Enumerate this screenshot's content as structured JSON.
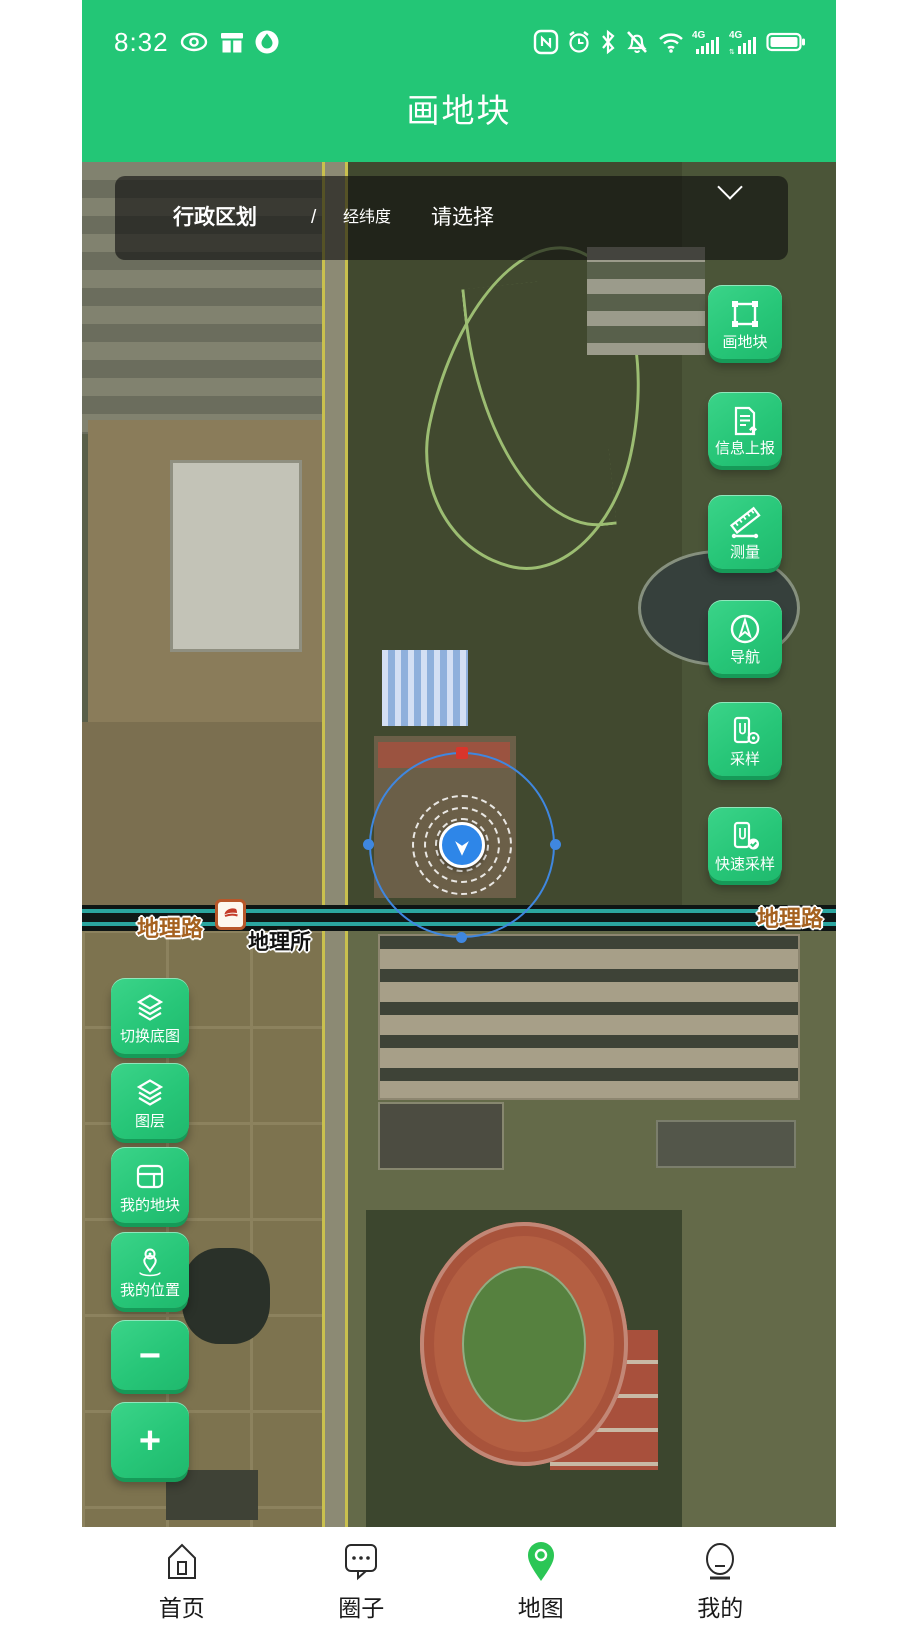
{
  "status_bar": {
    "time": "8:32",
    "left_icons": [
      "eye-icon",
      "gift-icon",
      "droplet-app-icon"
    ],
    "right_icons": [
      "nfc-icon",
      "alarm-icon",
      "bluetooth-icon",
      "bell-off-icon",
      "wifi-icon",
      "signal-4g-sim1-icon",
      "signal-4g-sim2-icon",
      "battery-icon"
    ],
    "nfc_letter": "N",
    "network_label_1": "4G",
    "network_label_2": "4G"
  },
  "header": {
    "title": "画地块"
  },
  "filter_bar": {
    "admin_label": "行政区划",
    "separator": "/",
    "lnglat_label": "经纬度",
    "placeholder": "请选择"
  },
  "map": {
    "labels": {
      "road_left": "地理路",
      "road_right": "地理路",
      "poi": "地理所"
    }
  },
  "right_tools": [
    {
      "icon": "draw-parcel-icon",
      "label": "画地块"
    },
    {
      "icon": "info-report-icon",
      "label": "信息上报"
    },
    {
      "icon": "measure-icon",
      "label": "测量"
    },
    {
      "icon": "navigate-icon",
      "label": "导航"
    },
    {
      "icon": "sample-icon",
      "label": "采样"
    },
    {
      "icon": "quick-sample-icon",
      "label": "快速采样"
    }
  ],
  "left_tools": [
    {
      "icon": "basemap-switch-icon",
      "label": "切换底图"
    },
    {
      "icon": "layers-icon",
      "label": "图层"
    },
    {
      "icon": "my-parcels-icon",
      "label": "我的地块"
    },
    {
      "icon": "my-location-icon",
      "label": "我的位置"
    },
    {
      "icon": "zoom-out-icon",
      "label": "−"
    },
    {
      "icon": "zoom-in-icon",
      "label": "+"
    }
  ],
  "bottom_nav": {
    "items": [
      {
        "icon": "home-icon",
        "label": "首页",
        "active": false
      },
      {
        "icon": "circle-chat-icon",
        "label": "圈子",
        "active": false
      },
      {
        "icon": "map-pin-icon",
        "label": "地图",
        "active": true
      },
      {
        "icon": "profile-icon",
        "label": "我的",
        "active": false
      }
    ]
  },
  "colors": {
    "header_green": "#23c676",
    "button_green": "#27c678",
    "button_shadow_green": "#169a58",
    "marker_blue": "#2e86e8",
    "selection_blue": "#3f87e0",
    "top_handle_red": "#d9352b",
    "road_label_brown": "#a5611f",
    "nav_active_green": "#2bc655"
  }
}
